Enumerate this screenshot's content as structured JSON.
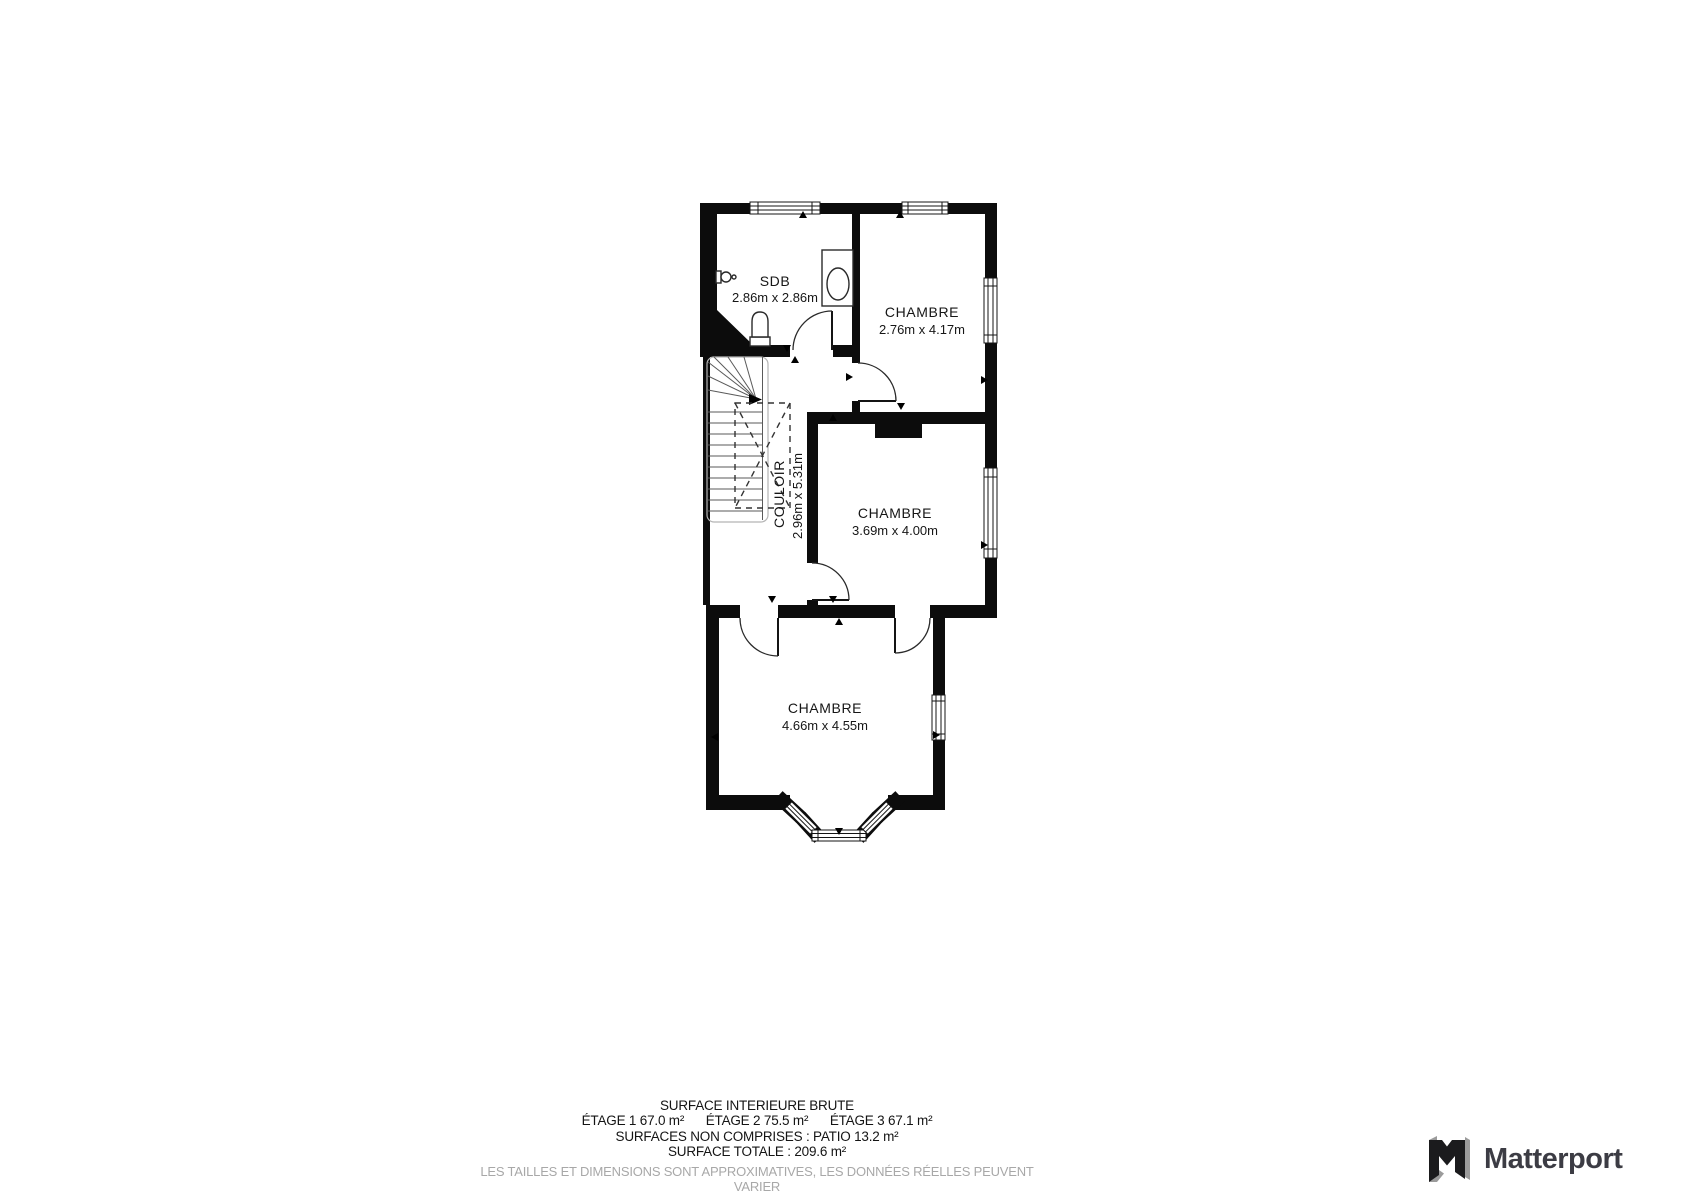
{
  "plan": {
    "rooms": [
      {
        "name": "SDB",
        "dims": "2.86m x 2.86m"
      },
      {
        "name": "CHAMBRE",
        "dims": "2.76m x 4.17m"
      },
      {
        "name": "COULOIR",
        "dims": "2.96m x 5.31m"
      },
      {
        "name": "CHAMBRE",
        "dims": "3.69m x 4.00m"
      },
      {
        "name": "CHAMBRE",
        "dims": "4.66m x 4.55m"
      }
    ]
  },
  "summary": {
    "title": "SURFACE INTERIEURE BRUTE",
    "floors": [
      "ÉTAGE 1 67.0 m²",
      "ÉTAGE 2 75.5 m²",
      "ÉTAGE 3 67.1 m²"
    ],
    "excluded": "SURFACES NON COMPRISES :  PATIO 13.2 m²",
    "total": "SURFACE TOTALE :  209.6 m²",
    "disclaimer": "LES TAILLES ET DIMENSIONS SONT APPROXIMATIVES, LES DONNÉES RÉELLES PEUVENT VARIER"
  },
  "branding": {
    "logo_text": "Matterport"
  },
  "colors": {
    "walls": "#0c0c0c",
    "background": "#ffffff",
    "disclaimer_text": "#a8a8a8",
    "brand_text": "#3c3c44",
    "brand_mark_dark": "#1b1b1d",
    "brand_mark_light": "#9b9b9b"
  }
}
